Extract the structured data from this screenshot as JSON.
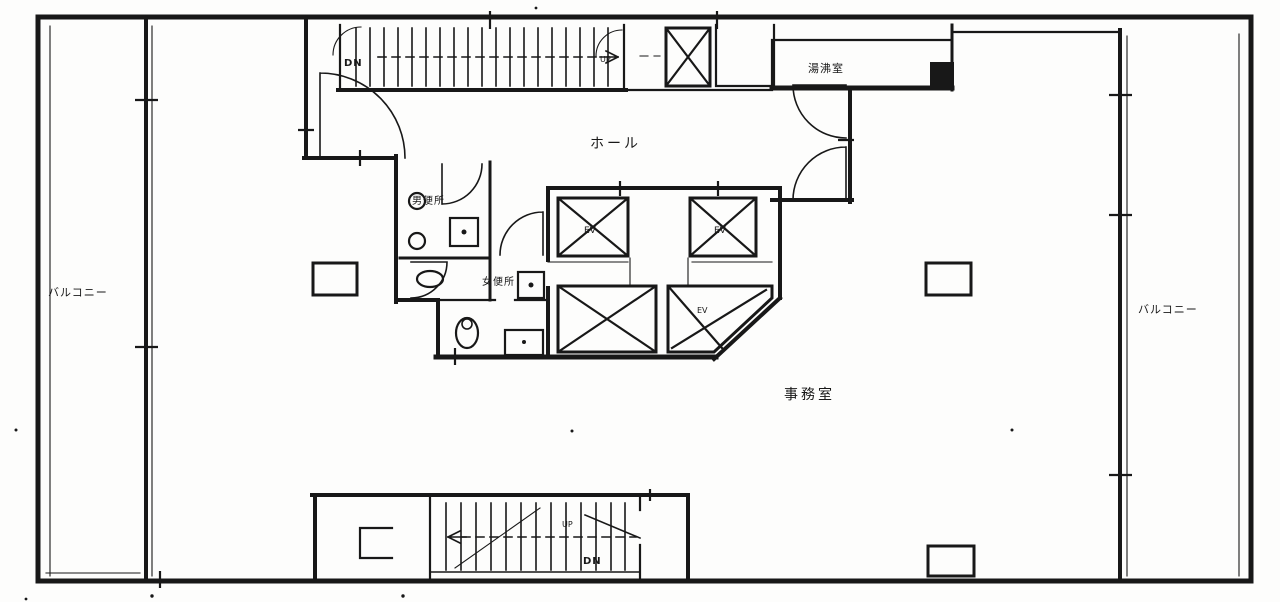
{
  "plan": {
    "labels": {
      "hall": "ホール",
      "office": "事務室",
      "balcony_left": "バルコニー",
      "balcony_right": "バルコニー",
      "mens_toilet": "男便所",
      "womens_toilet": "女便所",
      "kitchenette": "湯沸室",
      "elevator": "EV",
      "top_stair_down": "DN",
      "top_stair_up": "UP",
      "bottom_stair_up": "UP",
      "bottom_stair_down": "DN"
    },
    "colors": {
      "ink": "#181818",
      "paper": "#fdfdfc"
    }
  }
}
